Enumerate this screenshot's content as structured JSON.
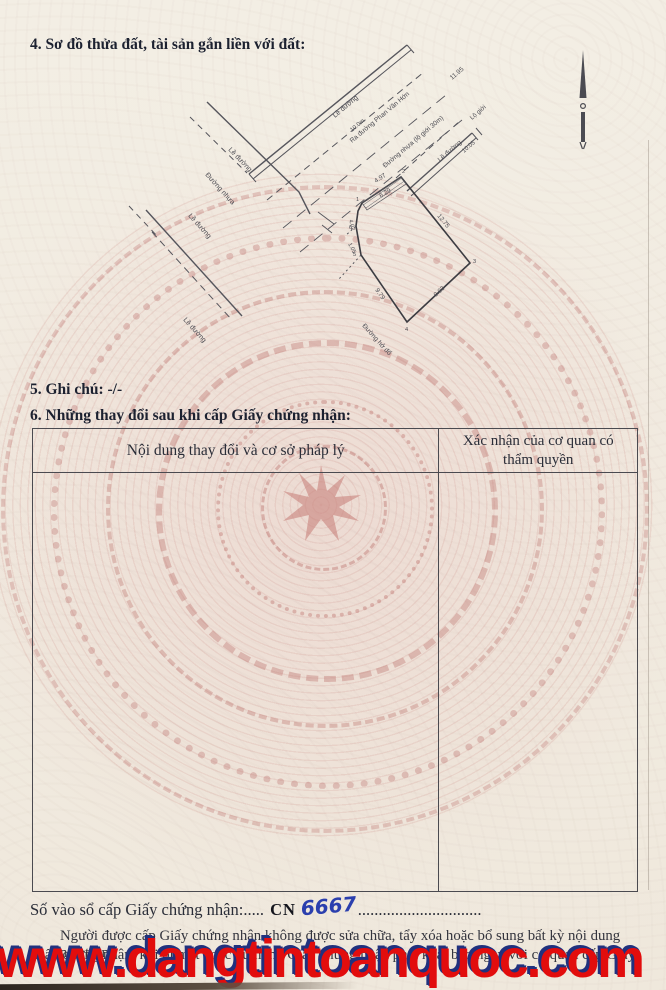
{
  "page": {
    "section4_title": "4. Sơ đồ thửa đất, tài sản gắn liền với đất:",
    "section5_title": "5. Ghi chú: -/-",
    "section6_title": "6. Những thay đổi sau khi cấp Giấy chứng nhận:"
  },
  "diagram": {
    "icons": {
      "north_arrow": "north-arrow-icon"
    },
    "road_labels": {
      "le_duong": "Lề đường",
      "duong_nhua": "Đường nhựa",
      "street_phan_van_hon": "Ra đường Phan Văn Hớn",
      "street_nhua_lo_gioi": "Đường nhựa (lộ giới 30m)",
      "lo_gioi": "Lộ giới",
      "duong_bottom": "Đường hở đổ"
    },
    "dims": {
      "road_width": "10.0m",
      "road_len": "11.95",
      "band_dim": "10.05",
      "top": "4.97",
      "top_inner": "6.29",
      "right": "12.75",
      "bottom_right": "9.03",
      "bottom_left": "9.79",
      "left_a": "4.02",
      "left_b": "1.05"
    },
    "vertices": [
      "1",
      "2",
      "3",
      "4",
      "5",
      "6"
    ]
  },
  "table": {
    "col1_header": "Nội dung thay đổi và cơ sở pháp lý",
    "col2_header": "Xác nhận của cơ quan có thẩm quyền"
  },
  "footer": {
    "so_vao_so_label": "Số vào sổ cấp Giấy chứng nhận:",
    "dots1": ".....",
    "cn": "CN",
    "number_handwritten": "6667",
    "dots2": "..............................",
    "note_line1": "Người được cấp Giấy chứng nhận không được sửa chữa, tẩy xóa hoặc bổ sung bất kỳ nội dung nào trong",
    "note_line2": "Giấy chứng nhận; khi bị mất hoặc hư hỏng Giấy chứng nhận phải khai báo ngay với cơ quan cấp Giấy"
  },
  "watermark": {
    "text": "www.dangtintoanquoc.com",
    "color": "#e20d0d",
    "shadow_color": "#20317e"
  },
  "colors": {
    "paper": "#f1ebe0",
    "drum_pink": "#c67c76",
    "heading_ink": "#1c2130",
    "table_line": "#4a4a50",
    "handwriting_blue": "#2b3fae"
  }
}
